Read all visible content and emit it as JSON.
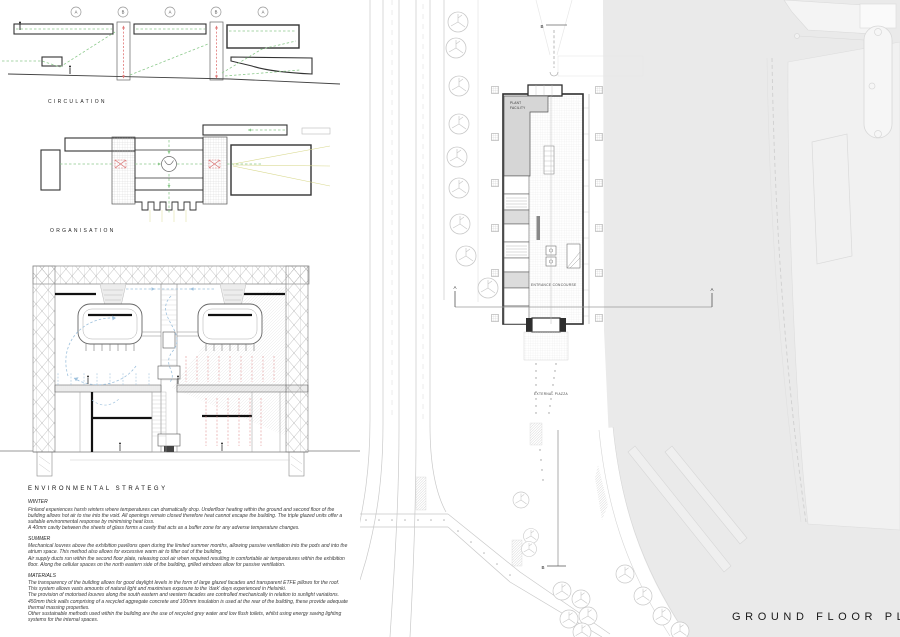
{
  "diagrams": {
    "circulation": {
      "label": "CIRCULATION",
      "markers": [
        "A",
        "B",
        "A",
        "B",
        "A"
      ]
    },
    "organisation": {
      "label": "ORGANISATION"
    },
    "environmental": {
      "heading": "ENVIRONMENTAL STRATEGY",
      "sections": [
        {
          "title": "WINTER",
          "body": "Finland experiences harsh winters where temperatures can dramatically drop. Underfloor heating within the ground and second floor of the building allows hot air to rise into the void. All openings remain closed therefore heat cannot escape the building. The triple glazed units offer a suitable environmental response by minimising heat loss.\nA 40mm cavity between the sheets of glass forms a cavity that acts as a buffer zone for any adverse temperature changes."
        },
        {
          "title": "SUMMER",
          "body": "Mechanical louvres above the exhibition pavilions open during the limited summer months, allowing passive ventilation into the pods and into the atrium space. This method also allows for excessive warm air to filter out of the building.\nAir supply ducts run within the second floor plate, releasing cool air when required resulting in comfortable air temperatures within the exhibition floor. Along the cellular spaces on the north eastern side of the building, grilled windows allow for passive ventilation."
        },
        {
          "title": "MATERIALS",
          "body": "The transparency of the building allows for good daylight levels in the form of large glazed facades and transparent ETFE pillows for the roof.\nThis system allows vasts amounts of natural light and maximises exposure to the 'dark' days experienced in Helsinki.\nThe provision of motorised louvres along the south eastern and western facades are controlled mechanically in relation to sunlight variations. 450mm thick walls comprising of a recycled aggregate concrete and 100mm insulation is used at the rear of the building, these provide adequate thermal massing properties.\nOther sustainable methods used within the building are the use of recycled grey water and low flush toilets, whilst using energy saving lighting systems for the internal spaces."
        }
      ]
    }
  },
  "plan": {
    "title": "GROUND FLOOR PLAN",
    "labels": {
      "plant": [
        "PLANT",
        "FACILITY"
      ],
      "entrance_concourse": "ENTRANCE CONCOURSE",
      "external_piazza": "EXTERNAL PIAZZA"
    },
    "sections": {
      "a_left": "A",
      "a_right": "A",
      "b_top": "B",
      "b_bottom": "B"
    }
  },
  "colors": {
    "water": "#eaeaea",
    "plant_room": "#d6d6d6",
    "accent_green": "#8cc98c",
    "accent_red": "#e07676",
    "accent_blue": "#9ec1dd"
  }
}
